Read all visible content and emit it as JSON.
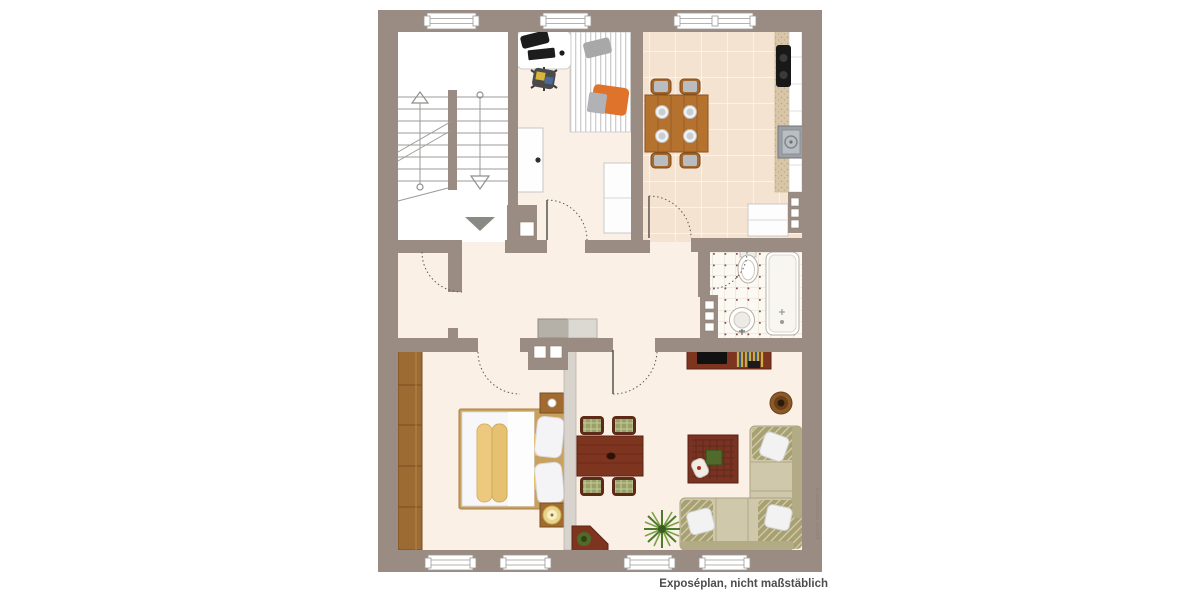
{
  "caption": {
    "text": "Exposéplan, nicht maßstäblich"
  },
  "watermark": {
    "text": "Exposéplan-Grafik"
  },
  "colors": {
    "wall": "#9a8c82",
    "floor_cream": "#fbf0e6",
    "kitchen_tile": "#f5e3d1",
    "bath_floor": "#fcf9f3",
    "stairwell_floor": "#ffffff",
    "light_partition": "#d8d3cc",
    "wood_light": "#b5722f",
    "wood_wardrobe": "#9c6a33",
    "mahogany": "#7e3520",
    "sofa_beige": "#cfc8aa",
    "sofa_pattern": "#a7a074",
    "blanket_yellow": "#ecc97f",
    "chair_orange": "#e0732c",
    "plant_green": "#4f7a2e",
    "caption_text": "#4d4d4d"
  }
}
